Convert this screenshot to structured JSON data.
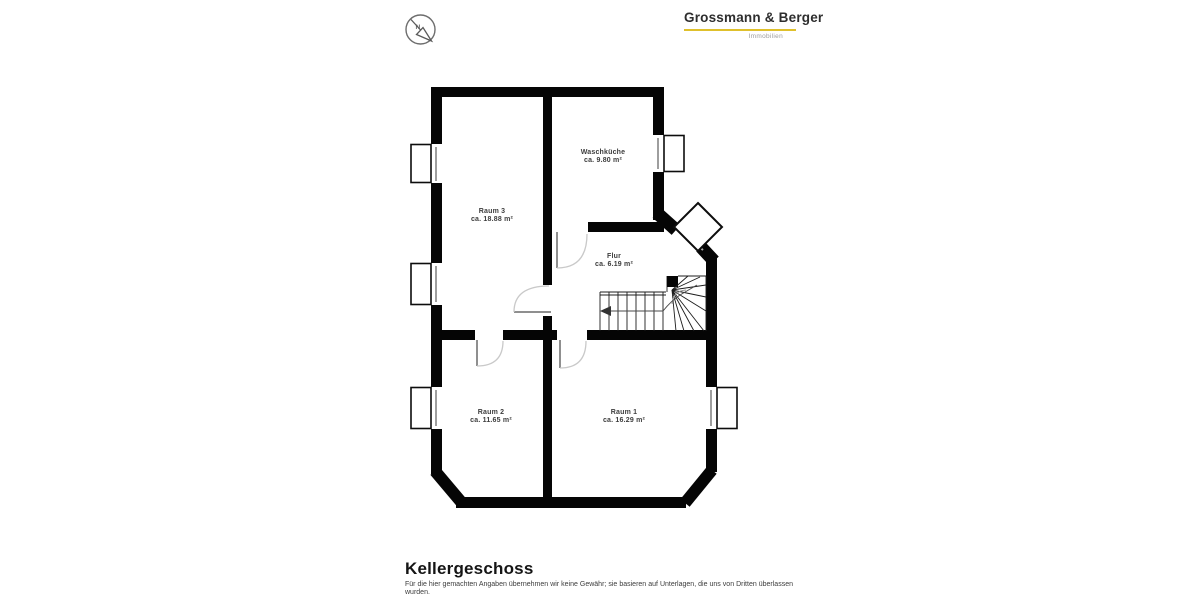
{
  "header": {
    "logo": {
      "brand": "Grossmann & Berger",
      "sub": "Immobilien",
      "underline_color": "#dfc02c"
    },
    "compass": {
      "label": "N"
    }
  },
  "floorplan": {
    "floor": "Kellergeschoss",
    "wall_color": "#050505",
    "rooms": [
      {
        "name": "Waschküche",
        "area": "ca. 9.80 m²"
      },
      {
        "name": "Raum 3",
        "area": "ca. 18.88 m²"
      },
      {
        "name": "Flur",
        "area": "ca. 6.19 m²"
      },
      {
        "name": "Raum 2",
        "area": "ca. 11.65 m²"
      },
      {
        "name": "Raum 1",
        "area": "ca. 16.29 m²"
      }
    ]
  },
  "footer": {
    "title": "Kellergeschoss",
    "disclaimer": "Für die hier gemachten Angaben übernehmen wir keine Gewähr; sie basieren auf Unterlagen, die uns von Dritten überlassen wurden."
  }
}
